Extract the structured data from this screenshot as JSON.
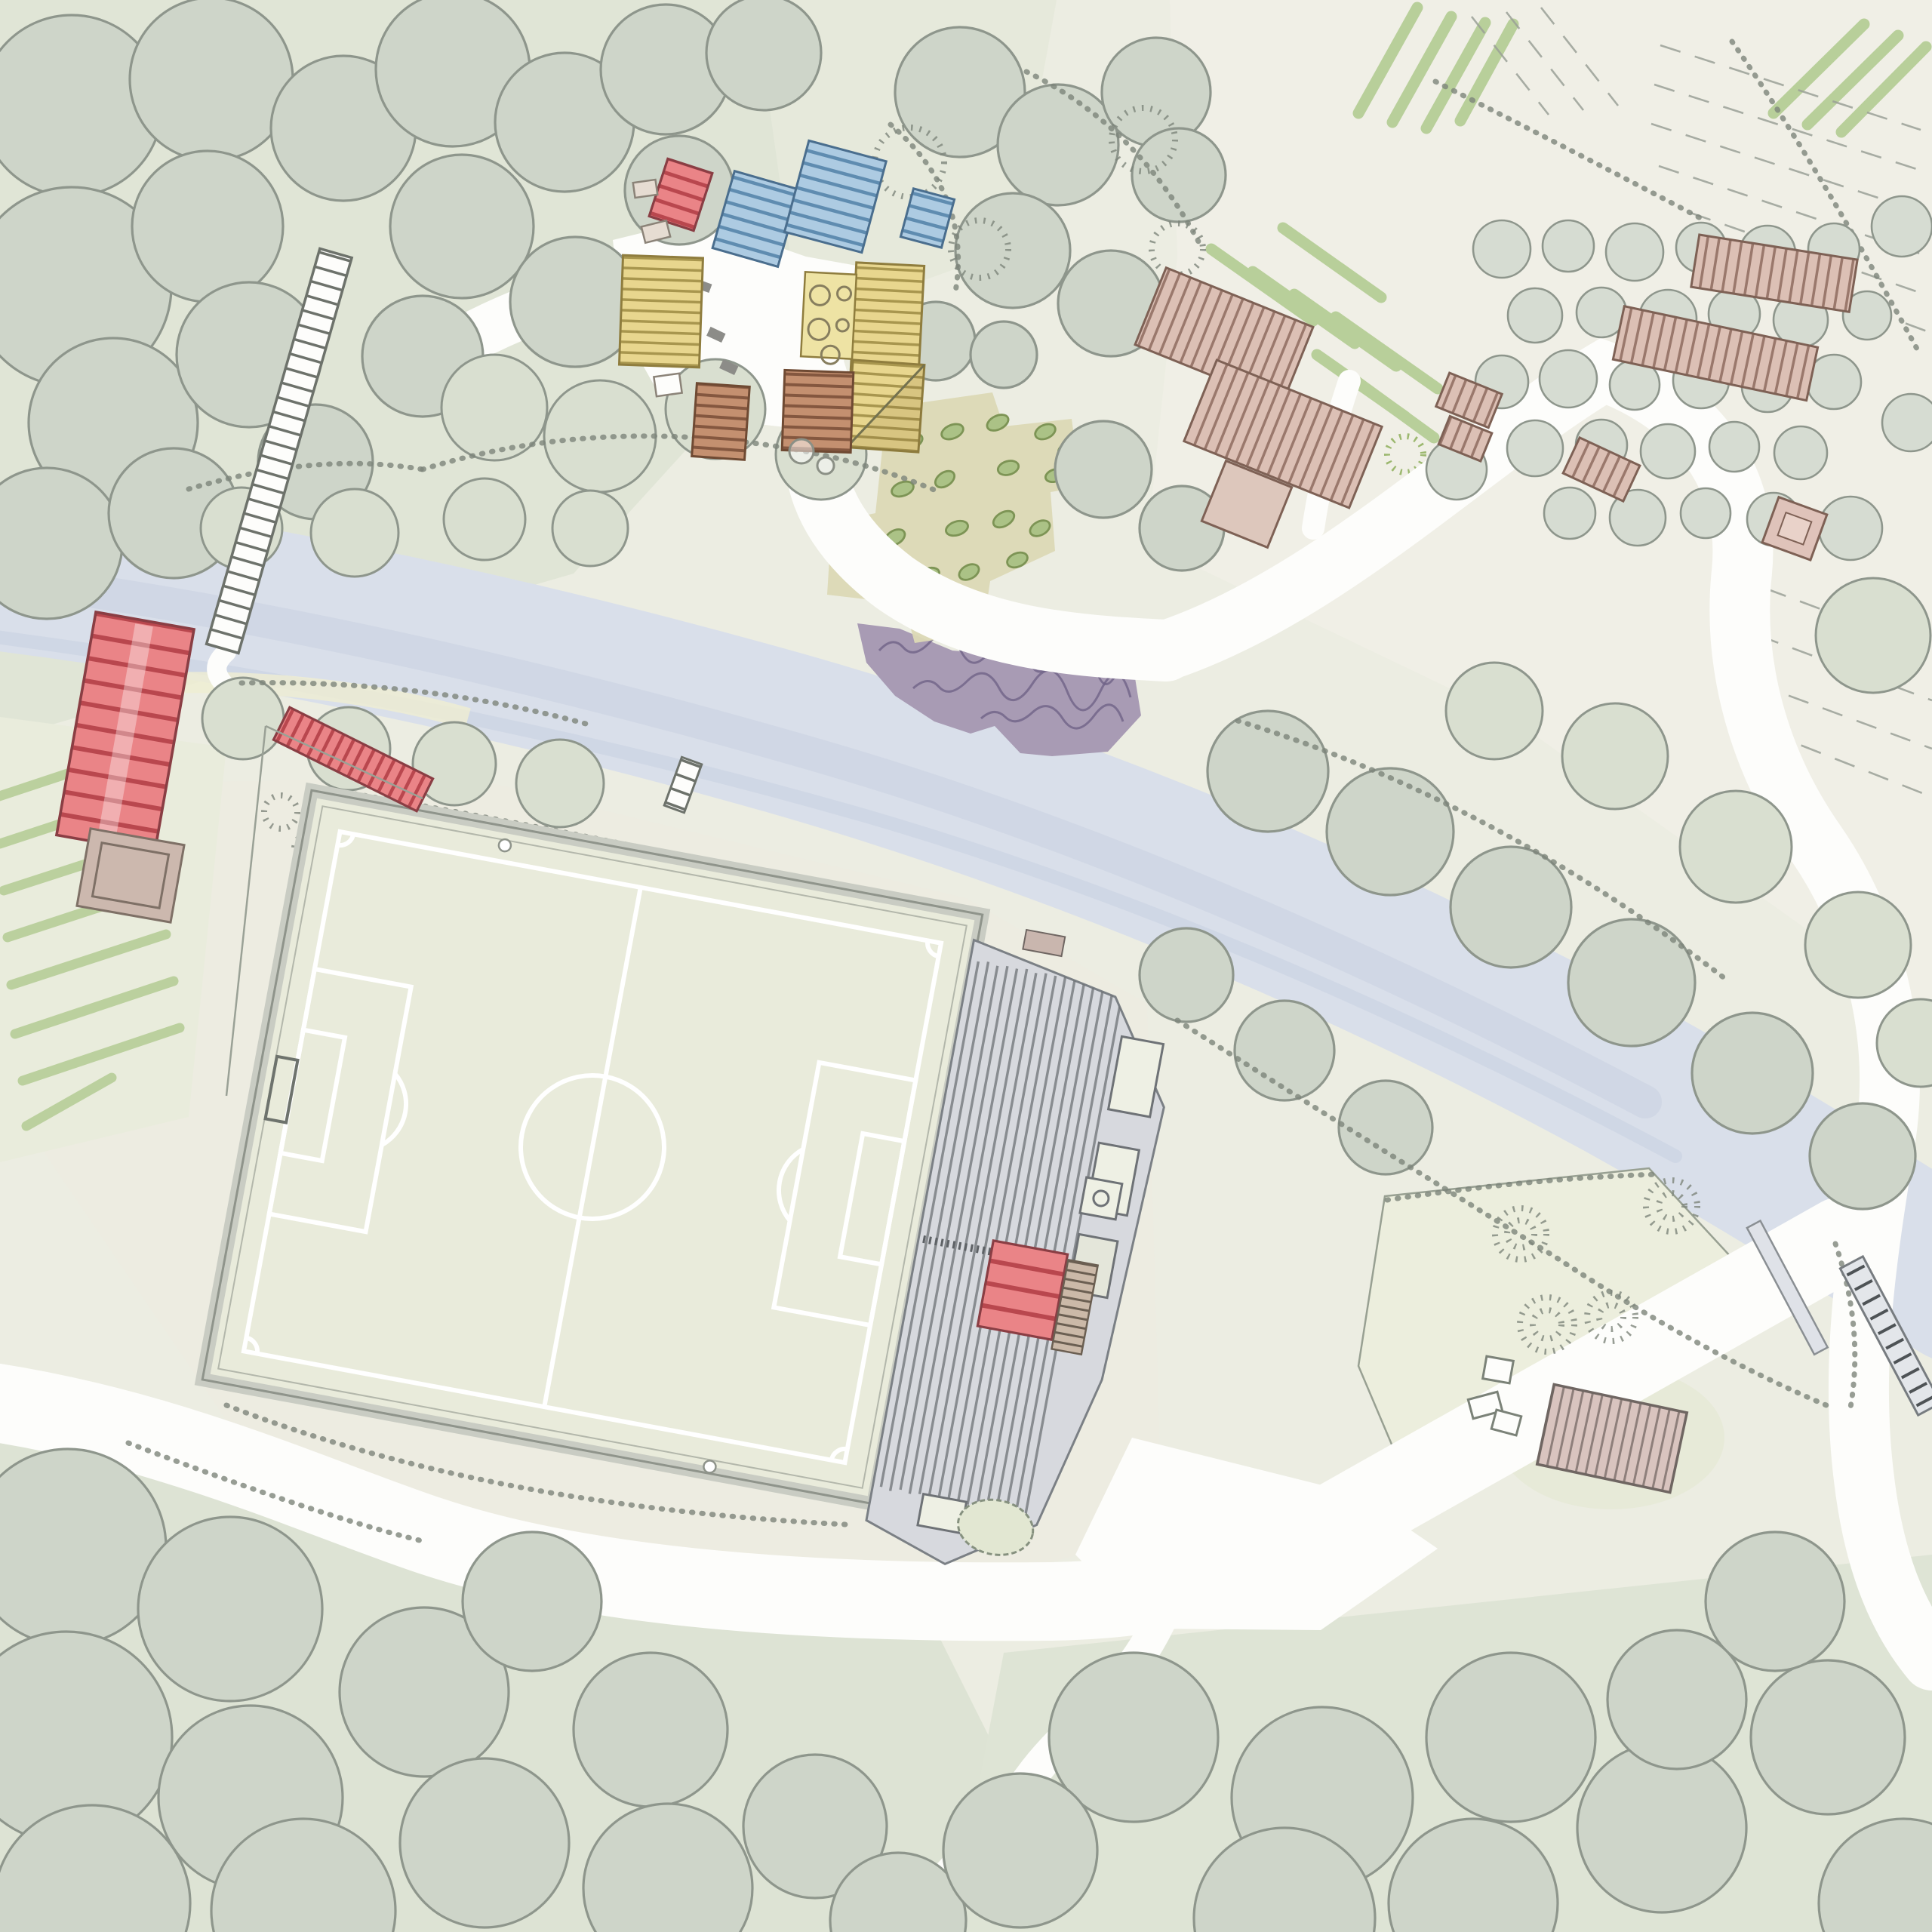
{
  "title": "hand-drawn watercolour site masterplan, aerial view",
  "colors": {
    "paper": "#ecede2",
    "wash_sage": "#e0e5d6",
    "wash_cream": "#f0efe6",
    "canopy": "#ced5c9",
    "canopy_light": "#d9dfd0",
    "orchard": "#d6dcd2",
    "outline": "#8e968c",
    "pencil": "#7d847b",
    "river": "#d9dfea",
    "river_deep": "#c7d0e0",
    "road": "#fdfdfb",
    "pitch": "#e9ebdb",
    "pitch_line": "#ffffff",
    "track": "#c9ccc3",
    "stand": "#d7d9de",
    "stand_line": "#6e7276",
    "red_fill": "#ea8487",
    "red_stripe": "#b9474e",
    "blue_fill": "#adcbe2",
    "blue_stripe": "#5f8cb0",
    "yellow_fill": "#e8d68e",
    "yellow_stripe": "#a8964e",
    "court_yellow": "#eee3a4",
    "brown_fill": "#c49070",
    "brown_stripe": "#84573f",
    "pink_fill": "#dcc0b5",
    "pink_stripe": "#9a786c",
    "mauve_fill": "#d9c4bf",
    "mauve_stripe": "#8e7f7b",
    "purple": "#a89bb4",
    "purple_line": "#6f6387",
    "crop": "#b8cf9a",
    "plant": "#abc286",
    "plant_line": "#7d9455",
    "khaki": "#dcd9b5",
    "porch": "#ccb8ae",
    "beige": "#e6dcd2"
  },
  "features": {
    "site_plan": "hand-drawn landscape site plan",
    "woodland_nw": "north-west woodland of tree canopies",
    "woodland_s": "southern woodland belt",
    "river": "river running north-west to south-east",
    "footbridge": "timber footbridge across the river",
    "riverside_planting": "purple riverside planting bed",
    "tent_red": "red striped tent pitch",
    "tents_blue": "blue striped tent pitches",
    "farm_yellow": "yellow-roofed farm buildings",
    "courtyard_tables": "courtyard with round tables",
    "barns_brown": "brown-roofed barns",
    "kitchen_garden": "kitchen garden with planted beds",
    "football_pitch": "football pitch with white markings",
    "terraces": "spectator terraces beside the pitch",
    "clubhouse": "red-roofed clubhouse in the terraces",
    "stand_boxes": "small stand buildings along the terrace edge",
    "pond": "small pond at the foot of the terraces",
    "entrance_barn": "large red entrance barn with porch",
    "long_barn": "long red outbuilding",
    "gate": "field gate",
    "vineyard": "vineyard rows on the western slope",
    "orchard": "orchard planted in a grid",
    "crop_rows": "green crop rows",
    "farmstead_pink": "pink-roofed farmstead cluster",
    "pink_sheds": "pink-roofed sheds and hut",
    "field_furrows": "ploughed field furrows",
    "meadow": "triangular meadow with shrub clusters",
    "rocks": "pale rocks in the meadow",
    "storage_barn": "mauve-roofed storage barn",
    "wall": "walled edge along the eastern lane",
    "roads": "white paths and lanes",
    "plaza": "white farmyard plaza"
  }
}
